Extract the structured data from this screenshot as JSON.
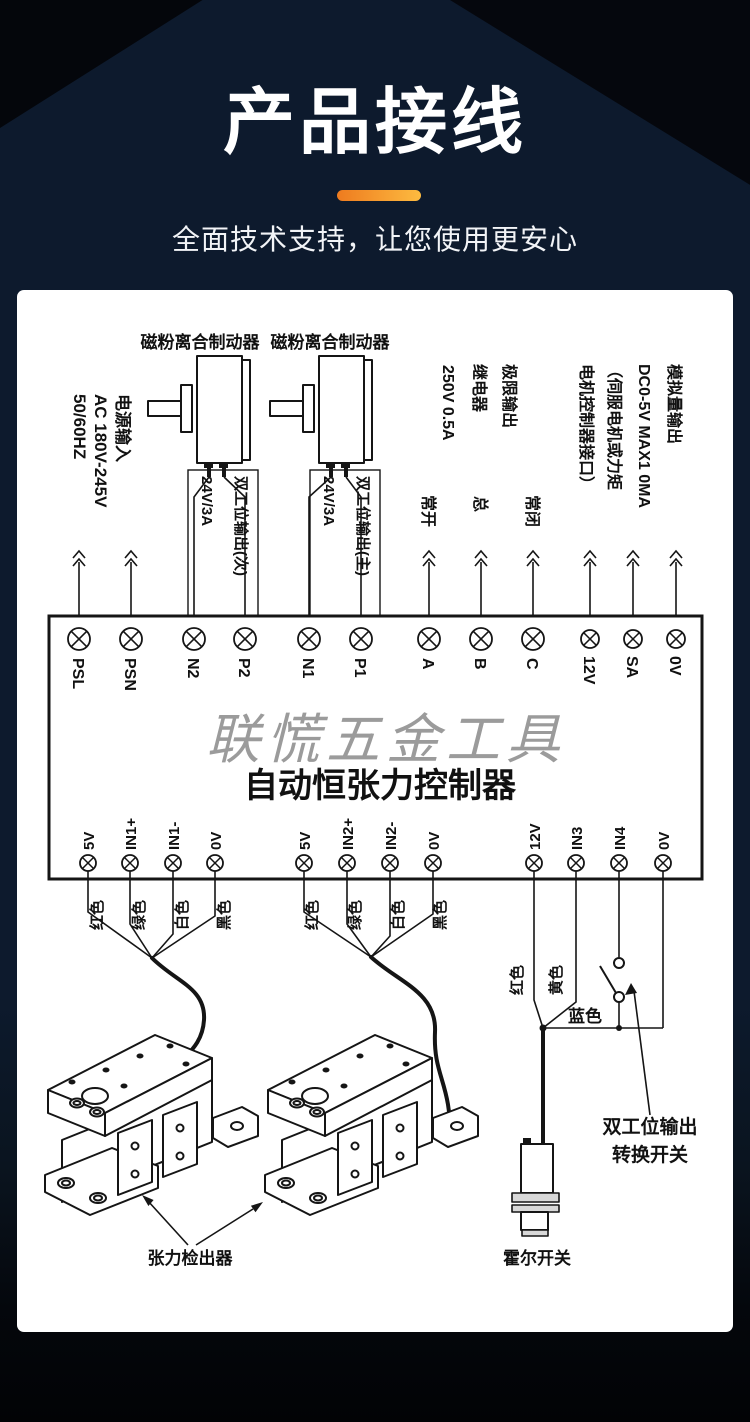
{
  "header": {
    "title": "产品接线",
    "subtitle": "全面技术支持，让您使用更安心",
    "accent_start": "#ee7b1f",
    "accent_end": "#fdbb40",
    "background": "#0d1a2d"
  },
  "diagram": {
    "brake_labels": [
      "磁粉离合制动器",
      "磁粉离合制动器"
    ],
    "power_input": [
      "电源输入",
      "AC 180V-245V",
      "50/60HZ"
    ],
    "relay_output": [
      "极限输出",
      "继电器",
      "250V  0.5A"
    ],
    "relay_contacts": [
      "常开",
      "总",
      "常闭"
    ],
    "analog_output": [
      "模拟量输出",
      "DC0-5V MAX1 0MA",
      "（伺服电机或力矩",
      "电机控制器接口）"
    ],
    "dual_output_secondary": [
      "双工位输出(次)",
      "24V/3A"
    ],
    "dual_output_primary": [
      "双工位输出(主)",
      "24V/3A"
    ],
    "watermark": "联慌五金工具",
    "controller_name": "自动恒张力控制器",
    "top_terminals": [
      "PSL",
      "PSN",
      "N2",
      "P2",
      "N1",
      "P1",
      "A",
      "B",
      "C",
      "12V",
      "SA",
      "0V"
    ],
    "bottom_terminals": [
      "5V",
      "IN1+",
      "IN1-",
      "0V",
      "5V",
      "IN2+",
      "IN2-",
      "0V",
      "12V",
      "IN3",
      "IN4",
      "0V"
    ],
    "sensor1_wires": [
      "红色",
      "绿色",
      "白色",
      "黑色"
    ],
    "sensor2_wires": [
      "红色",
      "绿色",
      "白色",
      "黑色"
    ],
    "hall_wires": [
      "红色",
      "黄色",
      "蓝色"
    ],
    "switch_label": [
      "双工位输出",
      "转换开关"
    ],
    "hall_label": "霍尔开关",
    "tension_label": "张力检出器"
  }
}
